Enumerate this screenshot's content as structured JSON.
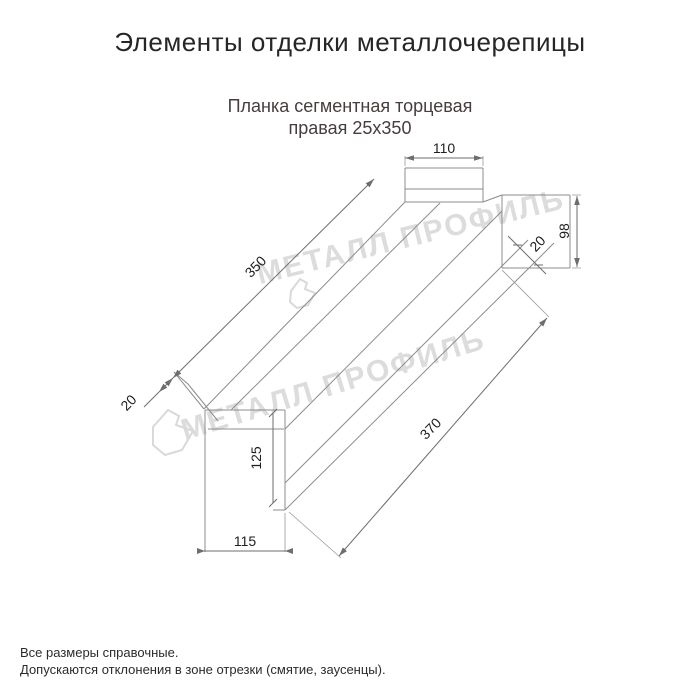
{
  "title": "Элементы отделки металлочерепицы",
  "subtitle": {
    "line1": "Планка сегментная торцевая",
    "line2": "правая 25x350"
  },
  "watermark": {
    "text": "МЕТАЛЛ ПРОФИЛЬ",
    "color": "#dcdcdc"
  },
  "dimensions": {
    "top_width": "110",
    "right_height": "98",
    "right_hem": "20",
    "length_top": "350",
    "left_hem": "20",
    "tab_height": "125",
    "tab_width": "115",
    "length_bottom": "370"
  },
  "footer": {
    "line1": "Все размеры справочные.",
    "line2": "Допускаются отклонения в зоне отрезки (смятие, заусенцы)."
  },
  "colors": {
    "line": "#8c8c8c",
    "dimension": "#6e6e6e",
    "text": "#1e1e1e",
    "subtitle": "#473d3d",
    "watermark": "#dcdcdc"
  }
}
